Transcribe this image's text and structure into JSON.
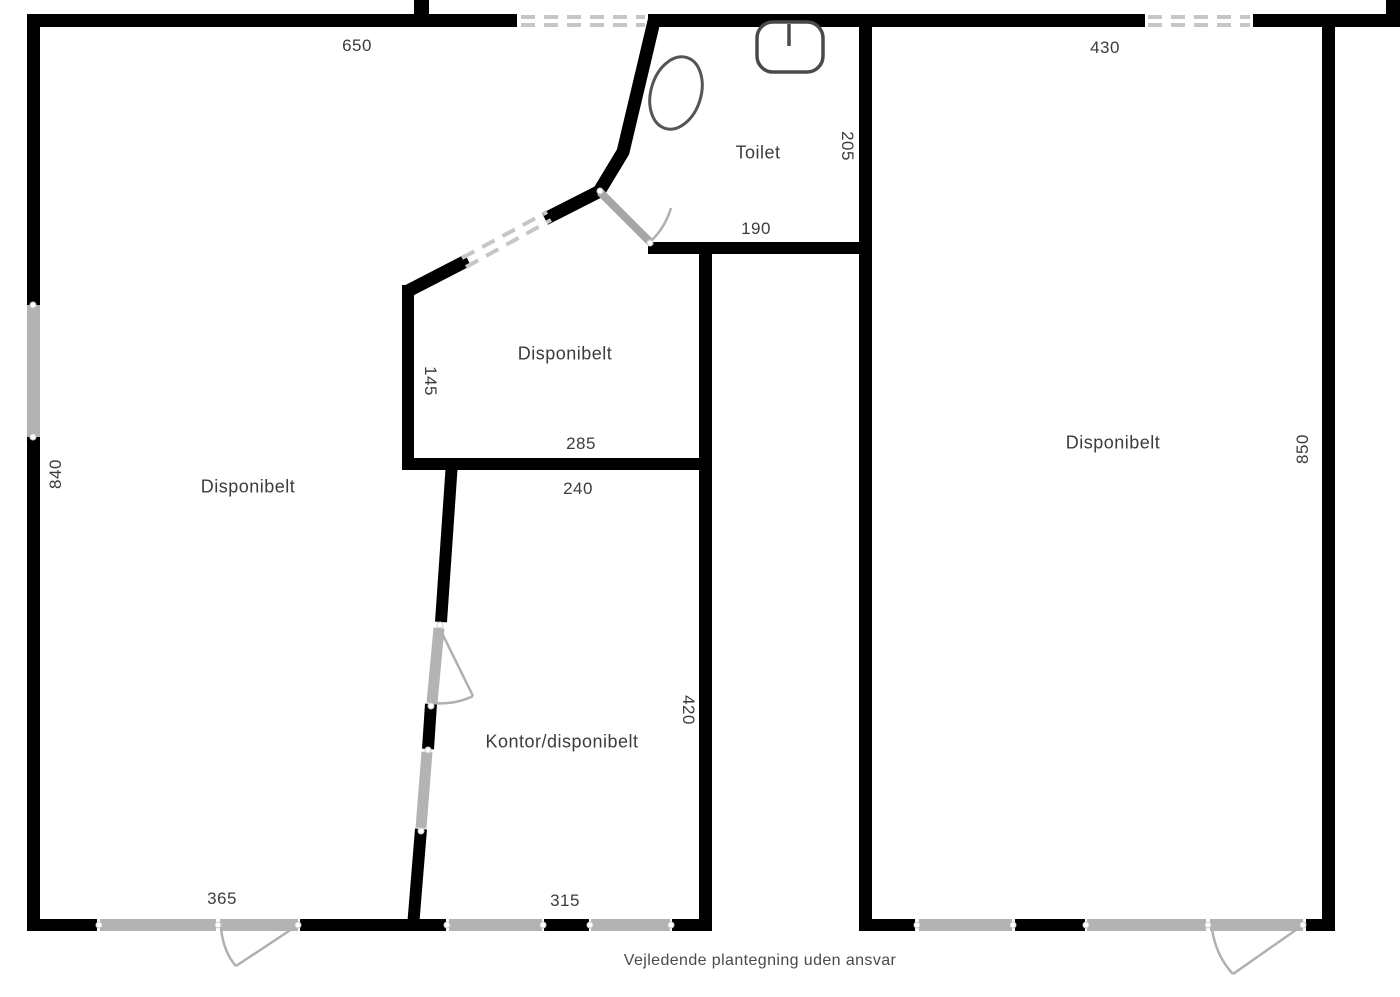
{
  "plan": {
    "type": "floor-plan",
    "footer_disclaimer": "Vejledende plantegning uden ansvar"
  },
  "rooms": {
    "left_room": {
      "label": "Disponibelt"
    },
    "middle_room": {
      "label": "Disponibelt"
    },
    "right_room": {
      "label": "Disponibelt"
    },
    "office_room": {
      "label": "Kontor/disponibelt"
    },
    "toilet_room": {
      "label": "Toilet"
    }
  },
  "dimensions": {
    "top_left_width": "650",
    "top_right_width": "430",
    "toilet_height": "205",
    "toilet_width": "190",
    "middle_room_height": "145",
    "middle_room_width": "285",
    "office_top_width": "240",
    "office_height": "420",
    "left_room_height": "840",
    "right_room_height": "850",
    "bottom_left_width": "365",
    "bottom_middle_width": "315"
  },
  "colors": {
    "wall": "#000000",
    "window_fill": "#b3b3b3",
    "door_leaf": "#a6a6a6",
    "swing_arc": "#b0b0b0",
    "opening_dash": "#c6c6c6",
    "fixture_stroke": "#4a4a4a",
    "text": "#3c3c3c"
  }
}
